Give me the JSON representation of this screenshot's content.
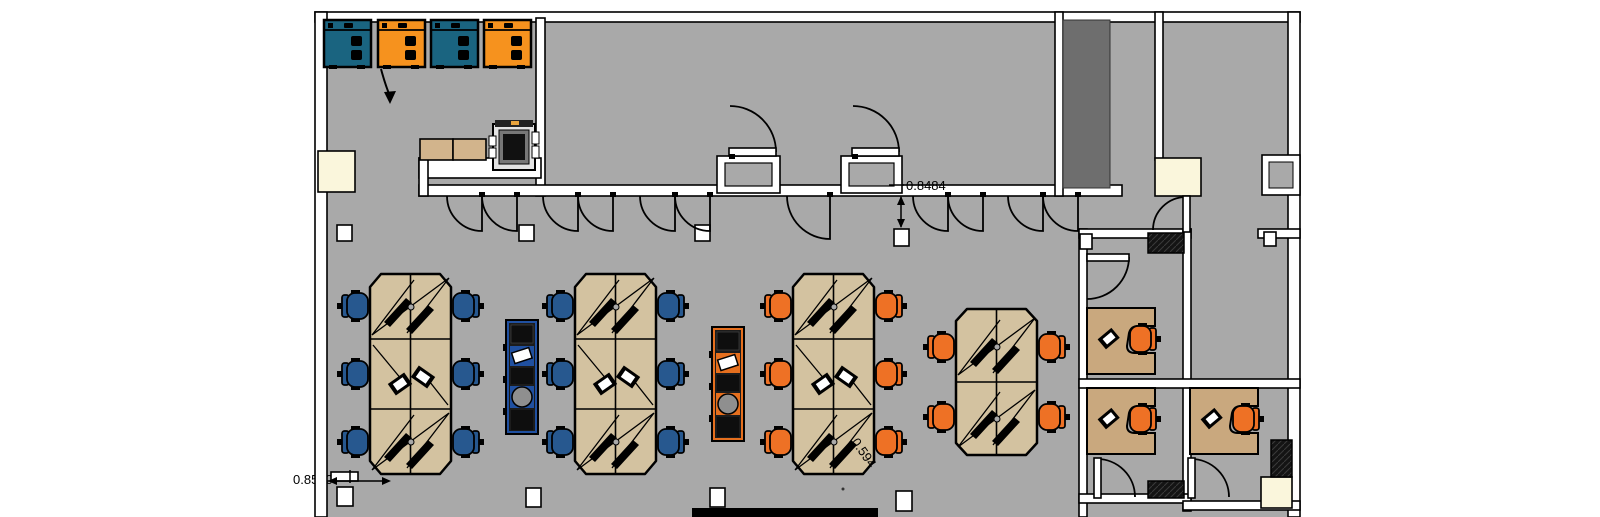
{
  "annotations": {
    "wall_offset_dim": "0.8484",
    "column_offset_dim": "0.594",
    "desk_clearance_dim": "0.8500"
  },
  "palette": {
    "floor": "#a9a9a9",
    "wall_fill": "#ffffff",
    "outline": "#000000",
    "cluster_desk_wood": "#d3c2a0",
    "office_desk_wood": "#c9a87e",
    "counter_wood": "#d2b48c",
    "chair_blue": "#27588f",
    "chair_orange": "#ee7125",
    "cabinet_teal": "#1a6480",
    "cabinet_orange": "#f6921e",
    "storage_trim_blue": "#2050a0",
    "storage_trim_orange": "#e56f1e",
    "cream_fixture": "#faf6dc",
    "shaft_gray": "#6e6e6e"
  },
  "furniture": {
    "workstation_clusters_6_seat": 3,
    "workstation_clusters_4_seat": 1,
    "blue_chair_clusters": 2,
    "orange_chair_clusters": 2,
    "private_offices": 3,
    "storage_cabinets_top": 4,
    "mid_floor_storage_units": 2,
    "copier": 1
  }
}
